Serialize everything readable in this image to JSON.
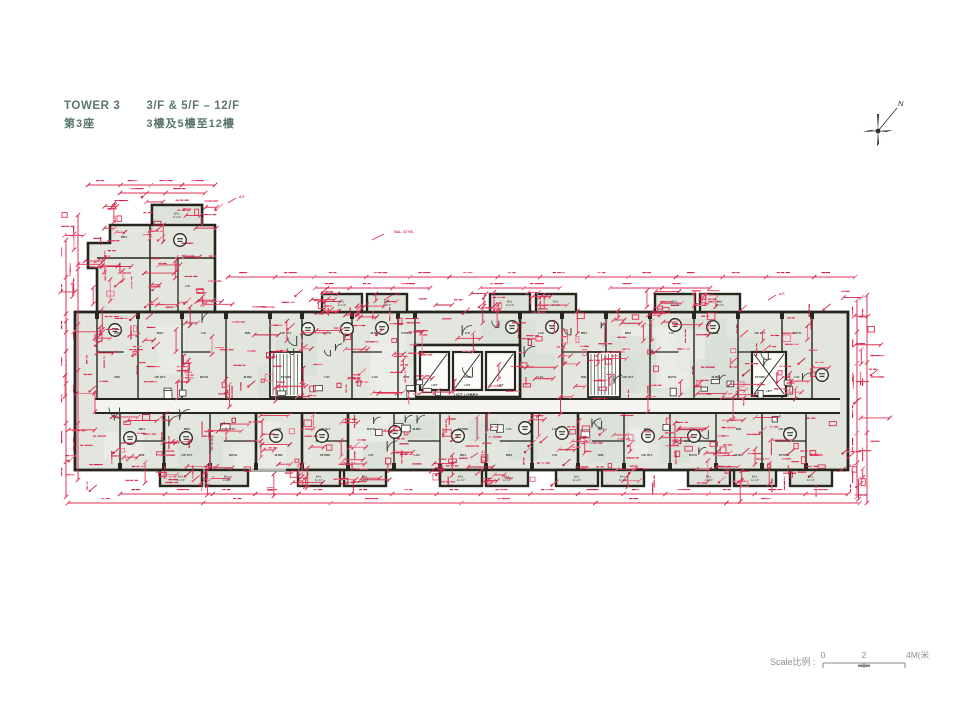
{
  "header": {
    "tower_en": "TOWER 3",
    "tower_zh": "第3座",
    "floors_en": "3/F & 5/F – 12/F",
    "floors_zh": "3樓及5樓至12樓"
  },
  "compass": {
    "north_label": "N"
  },
  "scale_bar": {
    "label": "Scale比例 :",
    "tick_labels": [
      "0",
      "2",
      "4M(米)"
    ]
  },
  "plan": {
    "lift_lobby_label": "LIFT LOBBY",
    "lift_label": "LIFT",
    "balcony_label": "BAL. & U.P.",
    "af_label": "A.F.",
    "bal_hl_label": "BAL. AT H/L",
    "room_labels": [
      "BR1",
      "BR2",
      "LIV.",
      "DIN.",
      "OP. KIT.",
      "BATH",
      "M.BR.",
      "STORE",
      "U.P.",
      "LAV."
    ]
  },
  "colors": {
    "accent_red": "#e23253",
    "accent_red_dark": "#c51f43",
    "accent_red_light": "#ef6e8a",
    "wall": "#26261f",
    "room_fill": "#e2e6df",
    "room_fill_alt": "#d7ded5",
    "title_teal": "#5b7671",
    "scale_gray": "#8f8f8c"
  }
}
